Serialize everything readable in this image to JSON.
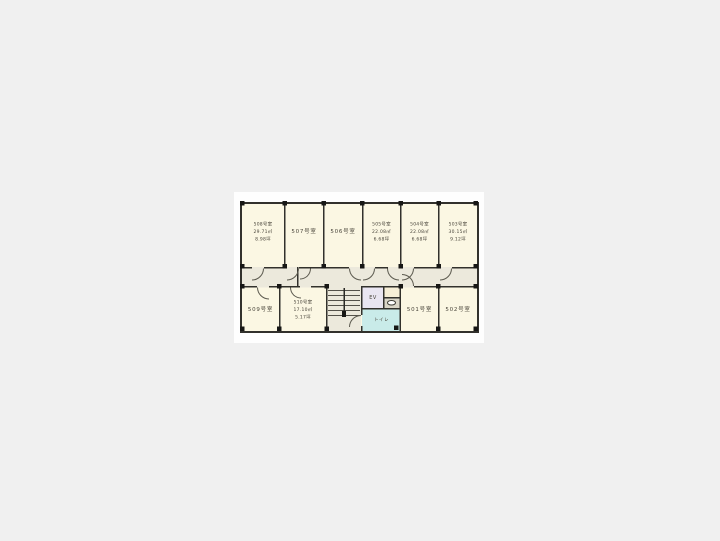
{
  "page": {
    "background_color": "#f0f0f0",
    "photo_background": "#fefefe"
  },
  "palette": {
    "room_fill": "#fbf7e3",
    "corridor_fill": "#ece9dc",
    "wall": "#32312c",
    "column": "#171715",
    "elevator_fill": "#e9e5f1",
    "toilet_fill": "#c9ebe9",
    "label_text": "#49453b"
  },
  "rooms": {
    "r508": {
      "name": "508号室",
      "area_m2": "29.71㎡",
      "area_tsubo": "8.98坪"
    },
    "r507": {
      "name": "507号室"
    },
    "r506": {
      "name": "506号室"
    },
    "r505": {
      "name": "505号室",
      "area_m2": "22.08㎡",
      "area_tsubo": "6.68坪"
    },
    "r504": {
      "name": "504号室",
      "area_m2": "22.08㎡",
      "area_tsubo": "6.68坪"
    },
    "r503": {
      "name": "503号室",
      "area_m2": "30.15㎡",
      "area_tsubo": "9.12坪"
    },
    "r509": {
      "name": "509号室"
    },
    "r510": {
      "name": "510号室",
      "area_m2": "17.10㎡",
      "area_tsubo": "5.17坪"
    },
    "r501": {
      "name": "501号室"
    },
    "r502": {
      "name": "502号室"
    }
  },
  "core": {
    "elevator_label": "EV",
    "toilet_label": "トイレ"
  }
}
